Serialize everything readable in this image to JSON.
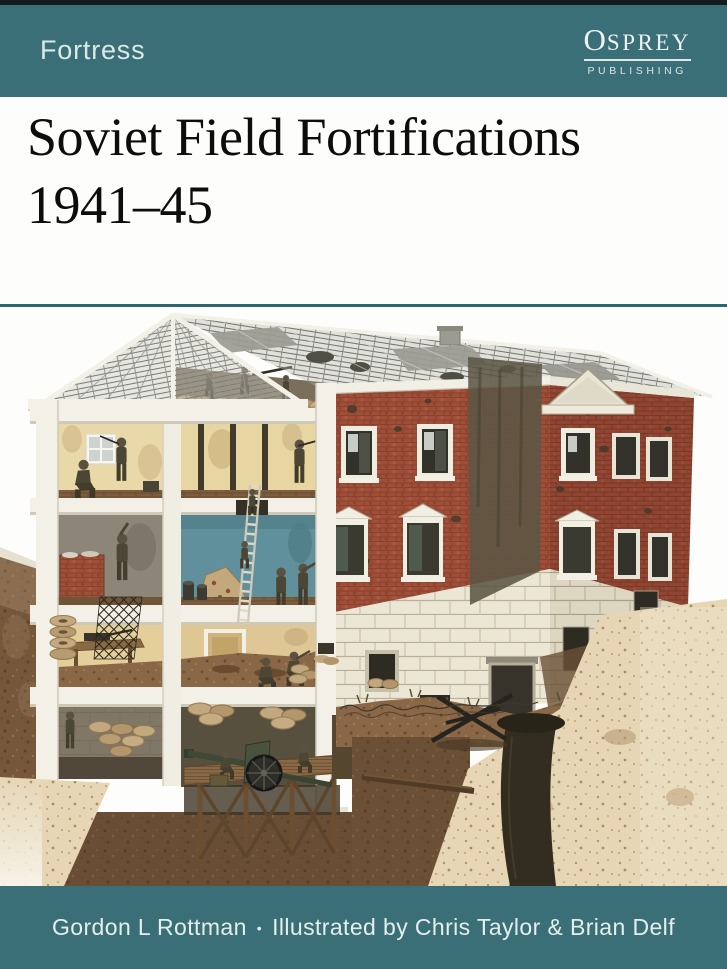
{
  "cover": {
    "series": "Fortress",
    "publisher": {
      "name_initial": "O",
      "name_rest": "SPREY",
      "tagline": "PUBLISHING"
    },
    "title_line1": "Soviet Field Fortifications",
    "title_line2": "1941–45",
    "byline": {
      "author": "Gordon L Rottman",
      "separator": "•",
      "credit": "Illustrated by Chris Taylor & Brian Delf"
    }
  },
  "palette": {
    "banner_teal": "#3b6f78",
    "banner_dark_edge": "#141c1e",
    "divider_teal": "#2c6671",
    "series_color": "#dce8e7",
    "logo_color": "#eef3f2",
    "byline_color": "#e4eeed",
    "title_color": "#0d0d0c",
    "cover_white": "#fdfdfb",
    "brick_red": "#9f4f37",
    "brick_shadow": "#8f4531",
    "stone_white": "#ece6d4",
    "smoke_stain": "#5c5746",
    "roof_grey": "#b7b6ae",
    "interior_cream": "#ead9a8",
    "interior_blue": "#60909c",
    "earth_brown": "#77573b",
    "earth_light": "#e6d6b6",
    "uniform_olive": "#4c4634",
    "gun_green": "#49523e"
  }
}
